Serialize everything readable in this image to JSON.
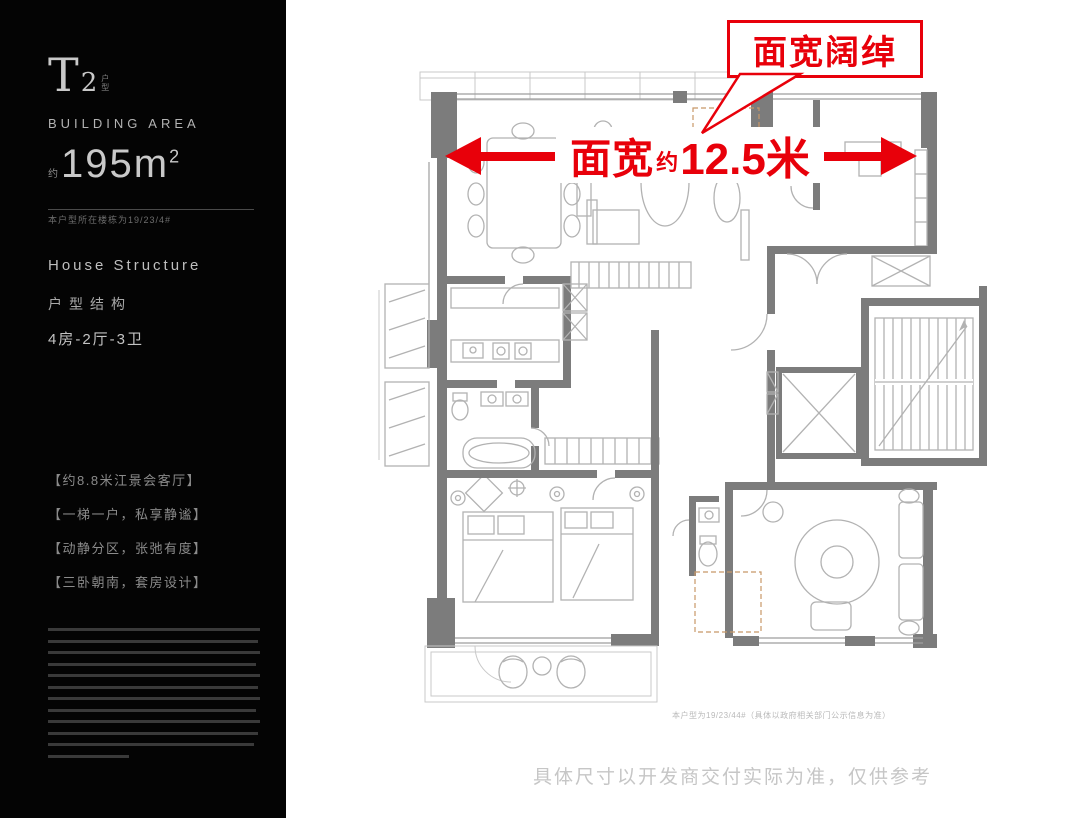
{
  "sidebar": {
    "unit_main": "T",
    "unit_num": "2",
    "unit_tag": "户型",
    "area_label": "BUILDING AREA",
    "area_approx": "约",
    "area_value": "195m",
    "area_sup": "2",
    "note": "本户型所在楼栋为19/23/4#",
    "structure_en": "House Structure",
    "structure_cn": "户型结构",
    "layout": "4房-2厅-3卫",
    "highlights": [
      "【约8.8米江景会客厅】",
      "【一梯一户，私享静谧】",
      "【动静分区，张弛有度】",
      "【三卧朝南，套房设计】"
    ]
  },
  "annotations": {
    "callout": "面宽阔绰",
    "width_label": "面宽",
    "width_approx": "约",
    "width_value": "12.5米",
    "footnote": "本户型为19/23/44#（具体以政府相关部门公示信息为准）",
    "disclaimer": "具体尺寸以开发商交付实际为准，仅供参考"
  },
  "colors": {
    "accent_red": "#e8000a",
    "wall_gray": "#7c7c7c",
    "sidebar_black": "#040404"
  }
}
